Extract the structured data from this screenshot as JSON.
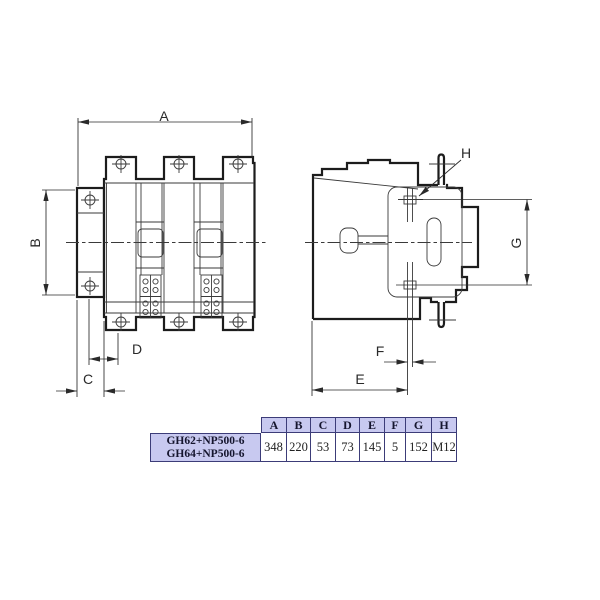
{
  "drawing": {
    "dim_labels": {
      "a": "A",
      "b": "B",
      "c": "C",
      "d": "D",
      "e": "E",
      "f": "F",
      "g": "G",
      "h": "H"
    }
  },
  "table": {
    "models": [
      "GH62+NP500-6",
      "GH64+NP500-6"
    ],
    "columns": [
      "A",
      "B",
      "C",
      "D",
      "E",
      "F",
      "G",
      "H"
    ],
    "values": [
      "348",
      "220",
      "53",
      "73",
      "145",
      "5",
      "152",
      "M12"
    ]
  },
  "colors": {
    "background": "#ffffff",
    "line_color": "#1c1c1c",
    "thin_line": "#3a3a3a",
    "dim_color": "#2a2a2a",
    "table_header_fill": "#c8c9f0",
    "table_border": "#3c3c78",
    "table_text": "#15152e",
    "value_text": "#222222"
  }
}
